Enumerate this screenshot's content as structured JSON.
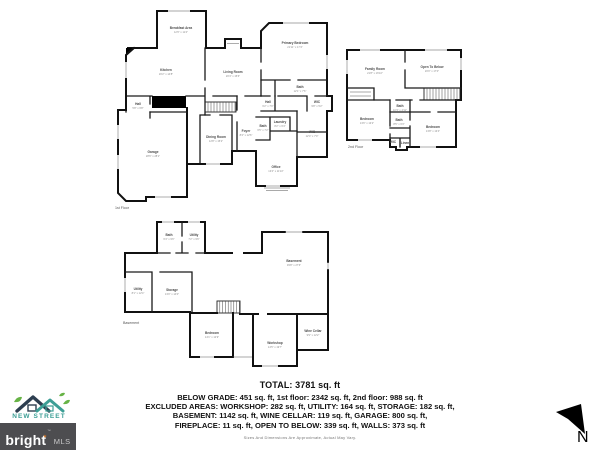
{
  "summary": {
    "total": "TOTAL: 3781 sq. ft",
    "line1": "BELOW GRADE: 451 sq. ft, 1st floor: 2342 sq. ft, 2nd floor: 988 sq. ft",
    "line2": "EXCLUDED AREAS: WORKSHOP: 282 sq. ft, UTILITY: 164 sq. ft, STORAGE: 182 sq. ft,",
    "line3": "BASEMENT: 1142 sq. ft, WINE CELLAR: 119 sq. ft, GARAGE: 800 sq. ft,",
    "line4": "FIREPLACE: 11 sq. ft, OPEN TO BELOW: 339 sq. ft, WALLS: 373 sq. ft",
    "disclaimer": "Sizes And Dimensions Are Approximate, Actual May Vary."
  },
  "branding": {
    "company": "NEW STREET",
    "mls_name": "bright",
    "mls_suffix": "MLS",
    "mls_tm": "TM",
    "flame_glyph": "✶",
    "banner_bg": "#4d4d50",
    "teal": "#3c9e95",
    "navy": "#2d3e50",
    "leaf_green": "#67b346",
    "flame_orange": "#f5821f"
  },
  "compass": {
    "label": "N"
  },
  "floors": {
    "first": {
      "label": "1st Floor",
      "label_x": 115,
      "label_y": 209,
      "rooms": [
        {
          "name": "Breakfast Area",
          "dims": "12'6\" x 11'4\"",
          "x": 181,
          "y": 29
        },
        {
          "name": "Kitchen",
          "dims": "20'2\" x 14'8\"",
          "x": 166,
          "y": 71
        },
        {
          "name": "Living Room",
          "dims": "20'4\" x 15'6\"",
          "x": 233,
          "y": 73
        },
        {
          "name": "Primary Bedroom",
          "dims": "21'11\" x 17'4\"",
          "x": 295,
          "y": 44
        },
        {
          "name": "Bath",
          "dims": "12'1\" x 7'6\"",
          "x": 300,
          "y": 88
        },
        {
          "name": "Hall",
          "dims": "6'2\" x 7'0\"",
          "x": 268,
          "y": 103
        },
        {
          "name": "WIC",
          "dims": "9'8\" x 5'2\"",
          "x": 317,
          "y": 103
        },
        {
          "name": "Hall",
          "dims": "5'8\" x 6'8\"",
          "x": 138,
          "y": 105
        },
        {
          "name": "Bath",
          "dims": "6'5\" x 7'2\"",
          "x": 263,
          "y": 127
        },
        {
          "name": "Laundry",
          "dims": "8'2\" x 6'4\"",
          "x": 280,
          "y": 123
        },
        {
          "name": "WIC",
          "dims": "12'4\" x 7'0\"",
          "x": 312,
          "y": 133
        },
        {
          "name": "Foyer",
          "dims": "8'4\" x 12'6\"",
          "x": 246,
          "y": 132
        },
        {
          "name": "Dining Room",
          "dims": "12'8\" x 15'2\"",
          "x": 216,
          "y": 138
        },
        {
          "name": "Office",
          "dims": "13'4\" x 11'10\"",
          "x": 276,
          "y": 168
        },
        {
          "name": "Garage",
          "dims": "28'6\" x 28'1\"",
          "x": 153,
          "y": 153
        }
      ]
    },
    "second": {
      "label": "2nd Floor",
      "label_x": 348,
      "label_y": 148,
      "rooms": [
        {
          "name": "Family Room",
          "dims": "21'8\" x 16'10\"",
          "x": 375,
          "y": 70
        },
        {
          "name": "Open To Below",
          "dims": "20'0\" x 17'0\"",
          "x": 432,
          "y": 68
        },
        {
          "name": "Bedroom",
          "dims": "13'6\" x 13'2\"",
          "x": 367,
          "y": 120
        },
        {
          "name": "Bath",
          "dims": "10'3\" x 4'11\"",
          "x": 400,
          "y": 107
        },
        {
          "name": "Bath",
          "dims": "8'5\" x 6'3\"",
          "x": 399,
          "y": 121
        },
        {
          "name": "WIC",
          "x": 393,
          "y": 143
        },
        {
          "name": "Linen",
          "x": 405,
          "y": 144
        },
        {
          "name": "Bedroom",
          "dims": "13'8\" x 13'4\"",
          "x": 433,
          "y": 128
        }
      ]
    },
    "basement": {
      "label": "Basement",
      "label_x": 123,
      "label_y": 324,
      "rooms": [
        {
          "name": "Bath",
          "dims": "6'4\" x 9'6\"",
          "x": 169,
          "y": 236
        },
        {
          "name": "Utility",
          "dims": "7'2\" x 9'6\"",
          "x": 194,
          "y": 236
        },
        {
          "name": "Basement",
          "dims": "39'8\" x 27'6\"",
          "x": 294,
          "y": 262
        },
        {
          "name": "Utility",
          "dims": "8'1\" x 12'4\"",
          "x": 138,
          "y": 290
        },
        {
          "name": "Storage",
          "dims": "13'0\" x 14'0\"",
          "x": 172,
          "y": 291
        },
        {
          "name": "Bedroom",
          "dims": "14'1\" x 12'9\"",
          "x": 212,
          "y": 334
        },
        {
          "name": "Workshop",
          "dims": "14'5\" x 19'7\"",
          "x": 275,
          "y": 344
        },
        {
          "name": "Wine Cellar",
          "dims": "9'9\" x 12'2\"",
          "x": 313,
          "y": 332
        }
      ]
    }
  }
}
